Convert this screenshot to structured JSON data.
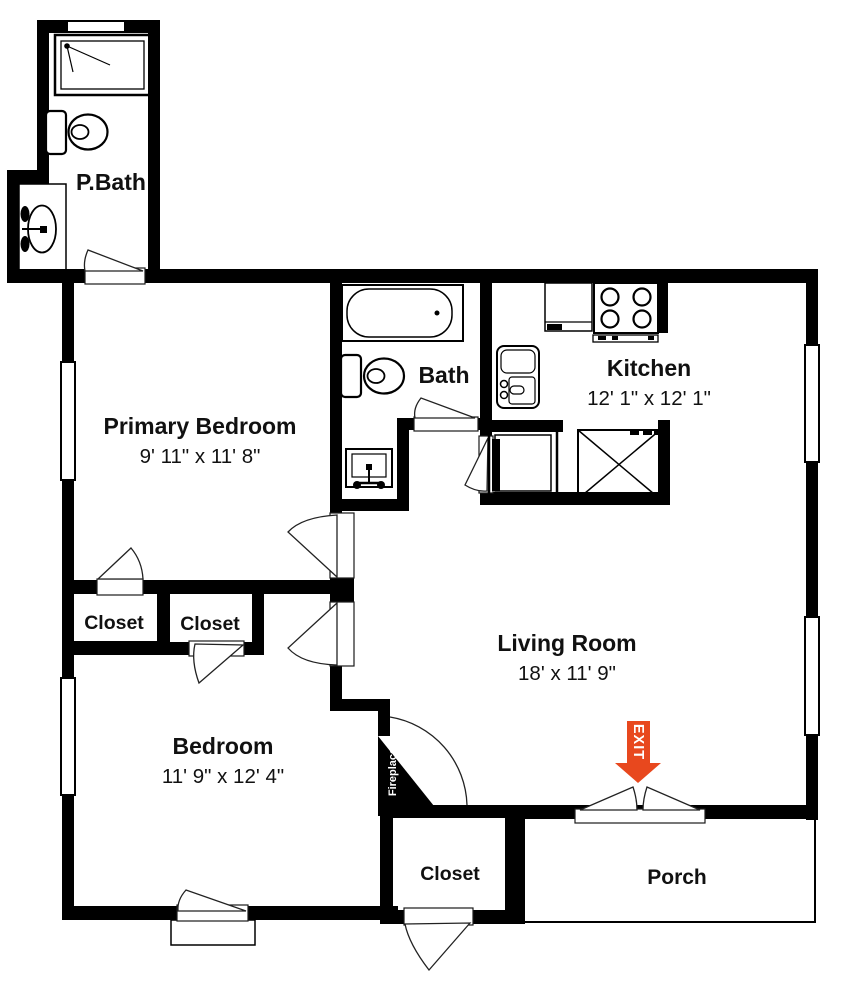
{
  "rooms": {
    "pbath": {
      "name": "P.Bath"
    },
    "primary_bedroom": {
      "name": "Primary Bedroom",
      "dims": "9' 11\" x 11' 8\""
    },
    "bath": {
      "name": "Bath"
    },
    "kitchen": {
      "name": "Kitchen",
      "dims": "12' 1\" x 12' 1\""
    },
    "living_room": {
      "name": "Living Room",
      "dims": "18' x 11' 9\""
    },
    "closet_a": {
      "name": "Closet"
    },
    "closet_b": {
      "name": "Closet"
    },
    "bedroom": {
      "name": "Bedroom",
      "dims": "11' 9\" x 12' 4\""
    },
    "closet_entry": {
      "name": "Closet"
    },
    "porch": {
      "name": "Porch"
    }
  },
  "annotations": {
    "exit": "EXIT",
    "fireplace": "Fireplace"
  },
  "colors": {
    "walls": "#000000",
    "exit_arrow": "#e8481e",
    "text": "#111111",
    "background": "#ffffff"
  }
}
